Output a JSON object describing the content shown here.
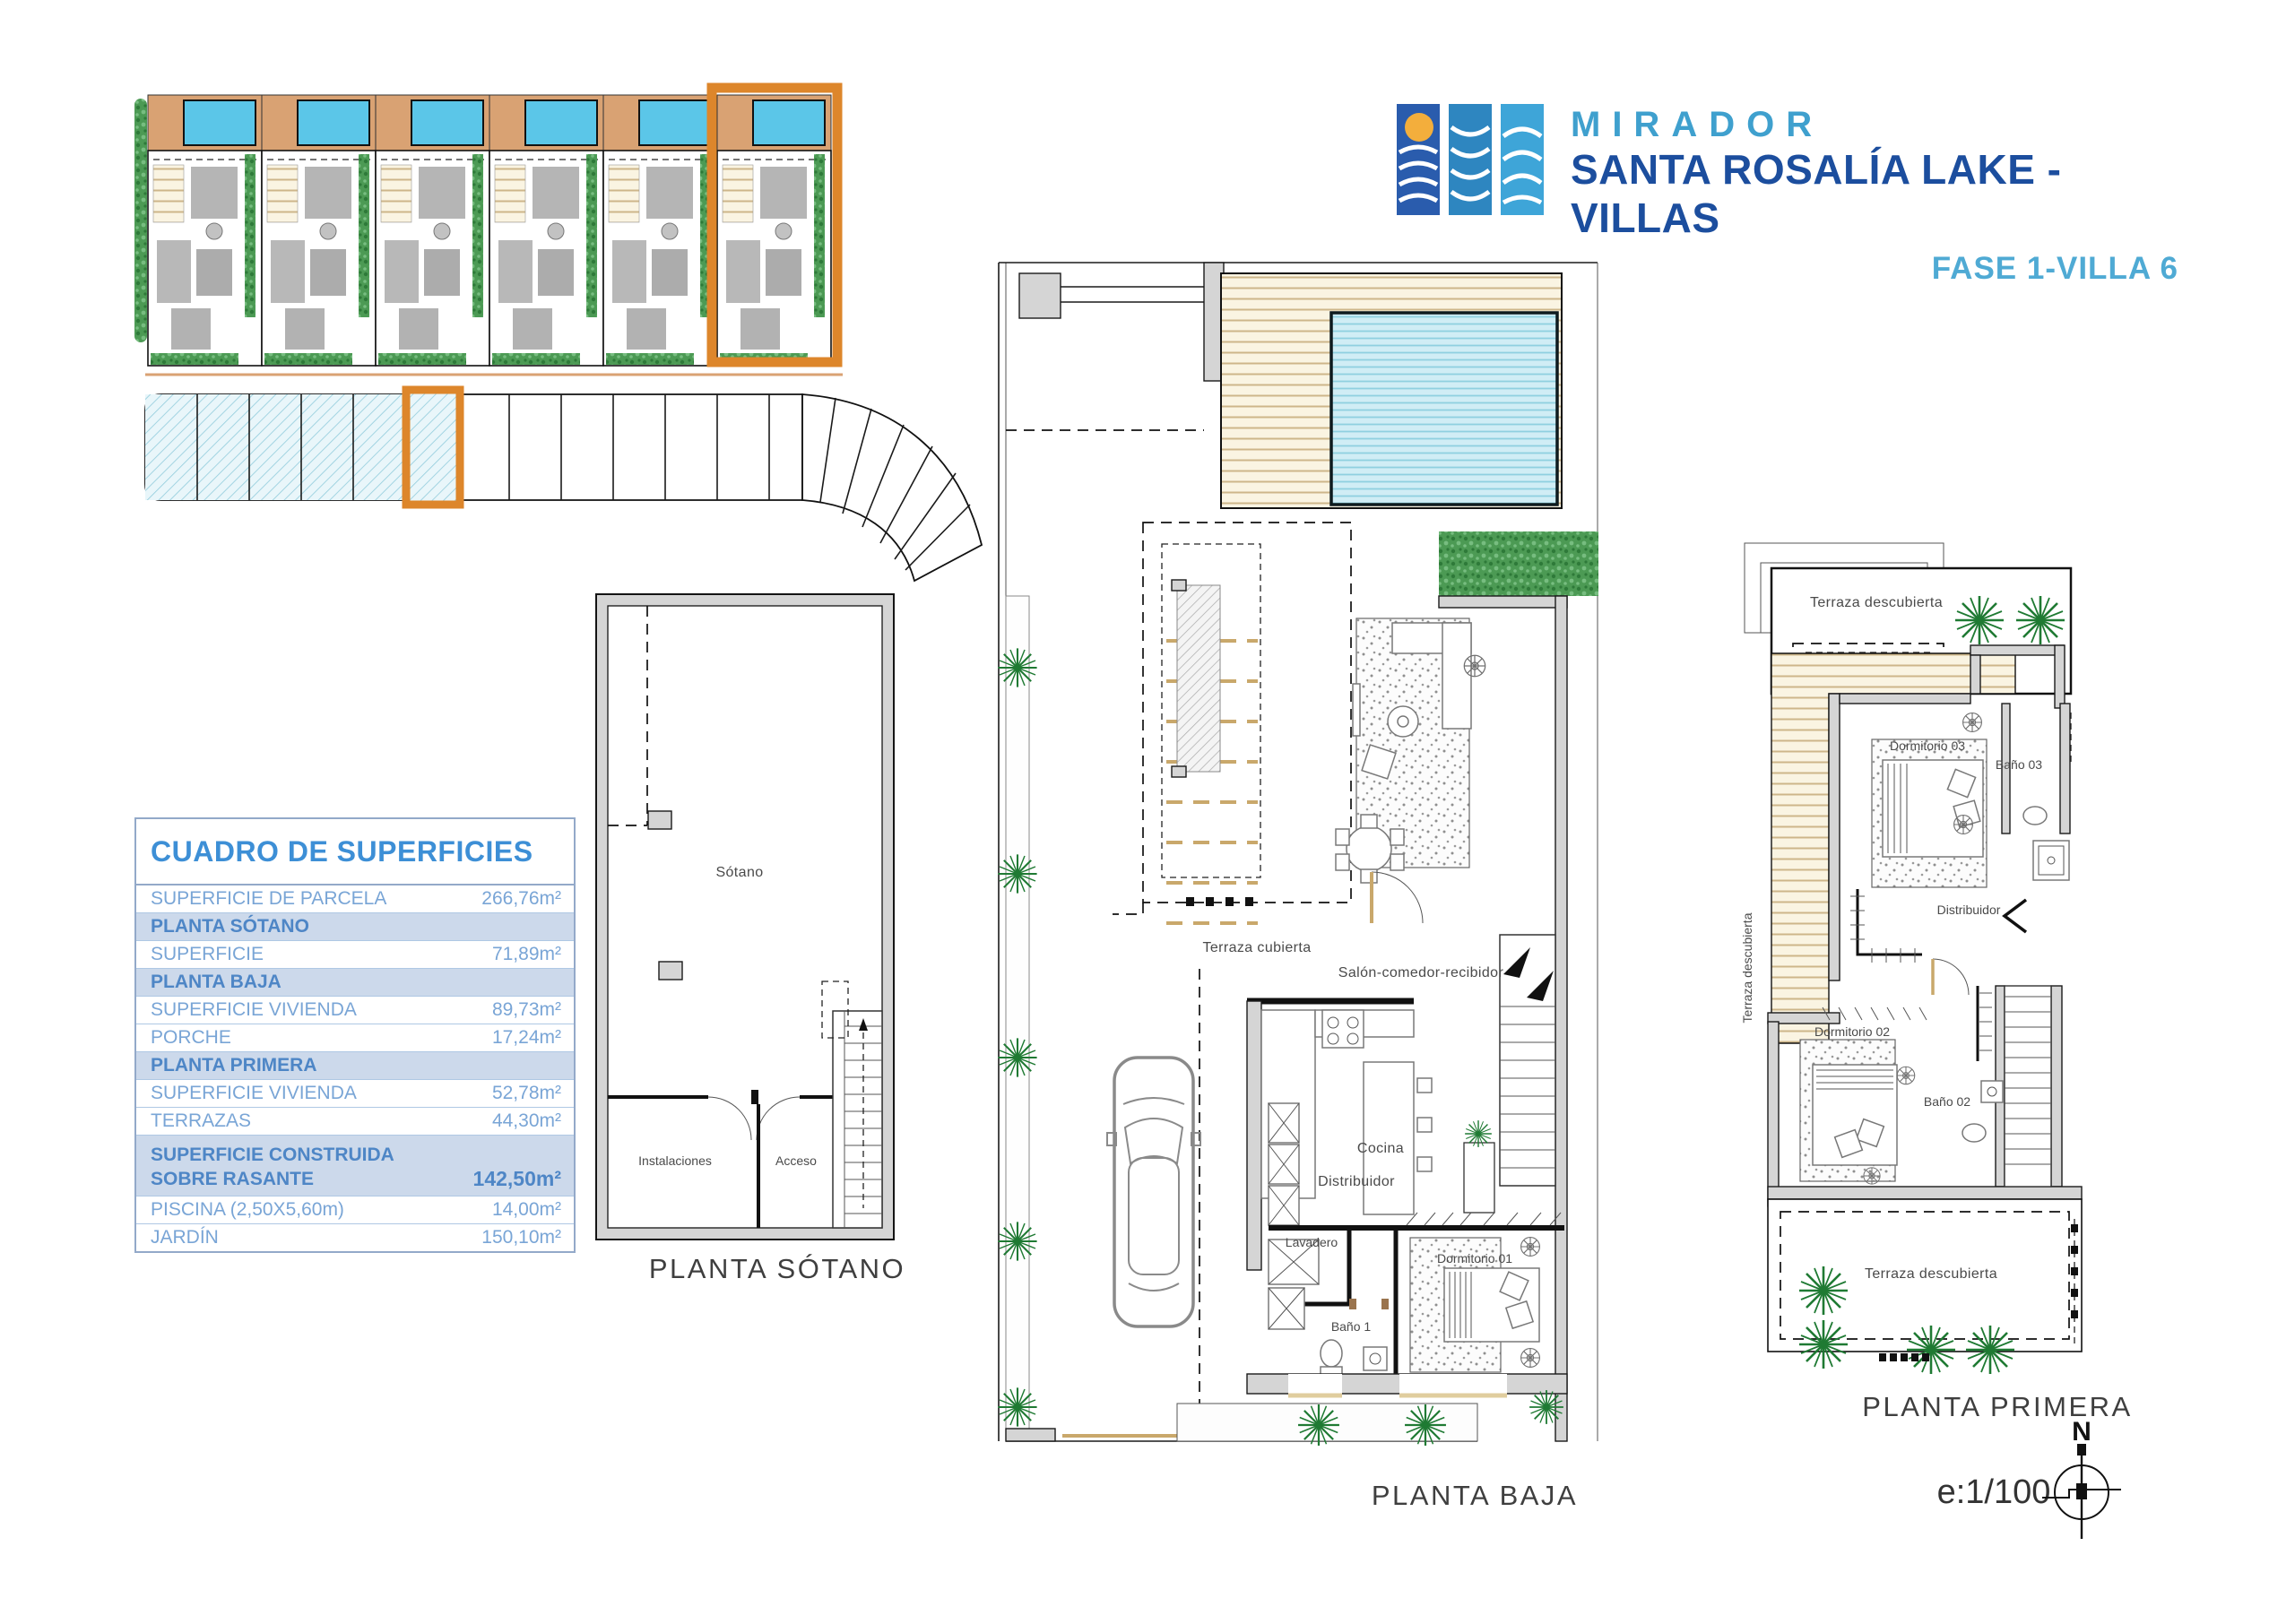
{
  "header": {
    "brand_top": "MIRADOR",
    "brand_main": "SANTA ROSALÍA LAKE - VILLAS",
    "phase": "FASE 1-VILLA 6"
  },
  "surfaces_table": {
    "title": "CUADRO DE SUPERFICIES",
    "rows": [
      {
        "type": "data",
        "label": "SUPERFICIE DE PARCELA",
        "value": "266,76m²"
      },
      {
        "type": "section",
        "label": "PLANTA SÓTANO"
      },
      {
        "type": "data",
        "label": "SUPERFICIE",
        "value": "71,89m²"
      },
      {
        "type": "section",
        "label": "PLANTA BAJA"
      },
      {
        "type": "data",
        "label": "SUPERFICIE VIVIENDA",
        "value": "89,73m²"
      },
      {
        "type": "data",
        "label": "PORCHE",
        "value": "17,24m²"
      },
      {
        "type": "section",
        "label": "PLANTA PRIMERA"
      },
      {
        "type": "data",
        "label": "SUPERFICIE VIVIENDA",
        "value": "52,78m²"
      },
      {
        "type": "data",
        "label": "TERRAZAS",
        "value": "44,30m²"
      },
      {
        "type": "total",
        "label_line1": "SUPERFICIE CONSTRUIDA",
        "label_line2": "SOBRE RASANTE",
        "value": "142,50m²"
      },
      {
        "type": "data",
        "label": "PISCINA (2,50X5,60m)",
        "value": "14,00m²"
      },
      {
        "type": "data",
        "label": "JARDÍN",
        "value": "150,10m²"
      }
    ]
  },
  "plans": {
    "sotano": {
      "title": "PLANTA SÓTANO",
      "rooms": {
        "main": "Sótano",
        "instalaciones": "Instalaciones",
        "acceso": "Acceso"
      }
    },
    "baja": {
      "title": "PLANTA BAJA",
      "rooms": {
        "terraza_cubierta": "Terraza cubierta",
        "salon": "Salón-comedor-recibidor",
        "cocina": "Cocina",
        "distribuidor": "Distribuidor",
        "lavadero": "Lavadero",
        "bano1": "Baño 1",
        "dormitorio01": "Dormitorio 01"
      }
    },
    "primera": {
      "title": "PLANTA PRIMERA",
      "rooms": {
        "terraza_sup": "Terraza descubierta",
        "terraza_lat": "Terraza descubierta",
        "dormitorio03": "Dormitorio 03",
        "bano03": "Baño 03",
        "distribuidor": "Distribuidor",
        "dormitorio02": "Dormitorio 02",
        "bano02": "Baño 02",
        "terraza_inf": "Terraza descubierta"
      }
    }
  },
  "compass": {
    "north": "N",
    "scale": "e:1/100"
  },
  "colors": {
    "accent_orange": "#DD862B",
    "pool_blue": "#5BC6E8",
    "deck_cream": "#FAF4E2",
    "tree_green": "#1F7A33",
    "hedge_green": "#4C9A54",
    "brand_blue_dark": "#1C4E9E",
    "brand_blue_light": "#3FA0CE",
    "wall_gray": "#D5D5D5"
  }
}
